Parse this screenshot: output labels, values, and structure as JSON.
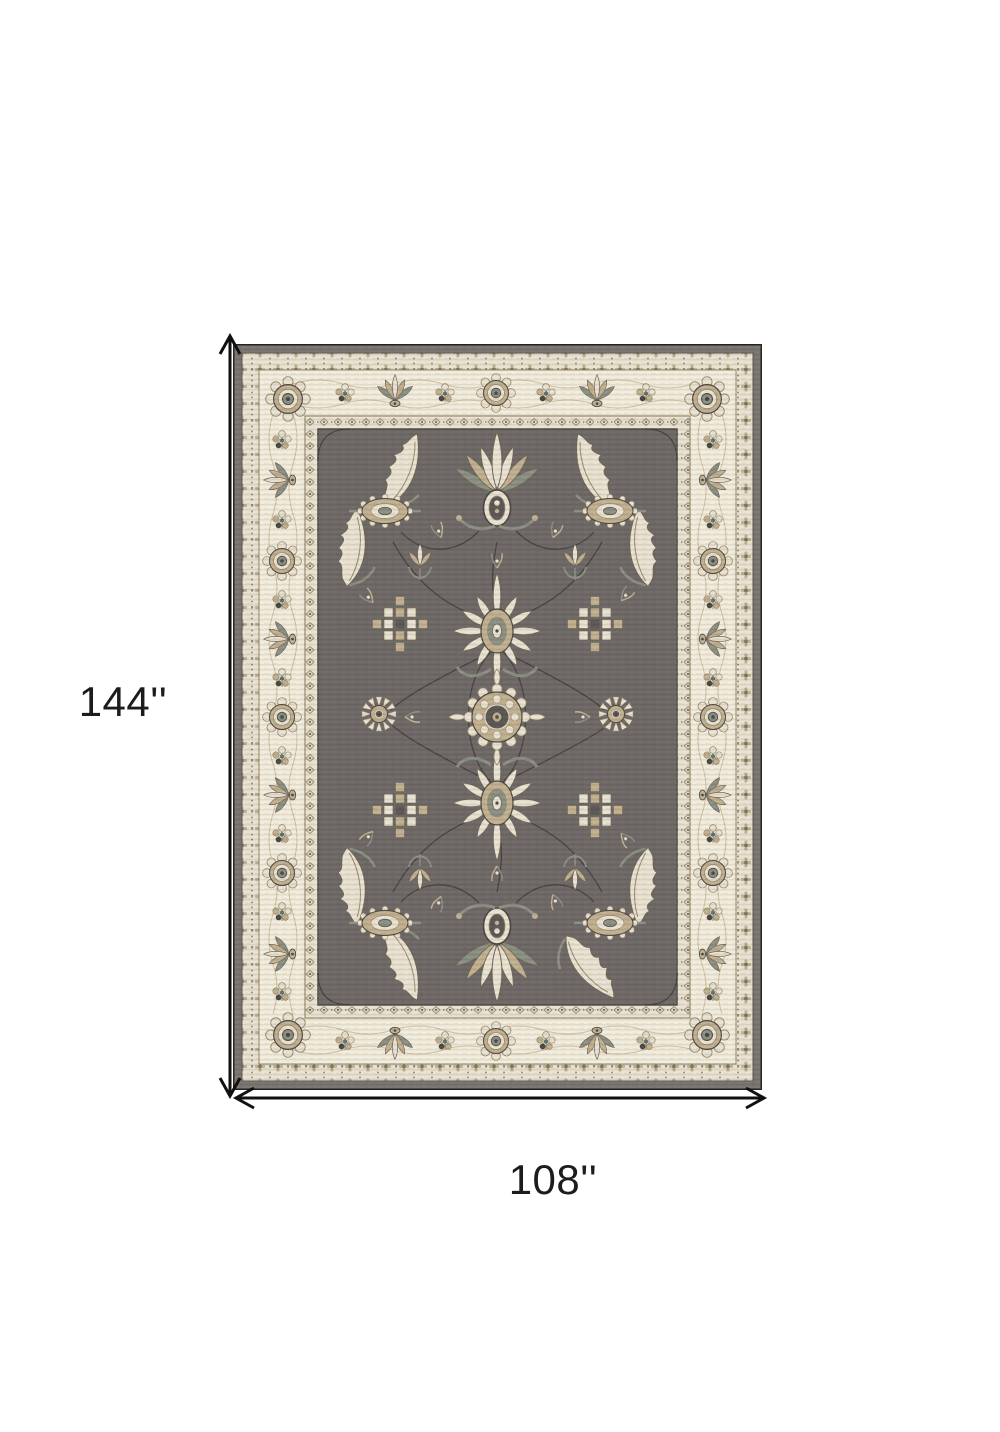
{
  "dimensions": {
    "height_label": "144''",
    "width_label": "108''"
  },
  "rug": {
    "name": "gray-and-ivory-oriental-area-rug",
    "style": "traditional floral bordered rug diagram",
    "colors": {
      "edge": "#7b7672",
      "edge_dark": "#4b4742",
      "field": "#6f6a67",
      "field_dark": "#5d5956",
      "ivory": "#e9e2d1",
      "ivory_hi": "#f2ecdc",
      "tan": "#c2b190",
      "tan_dark": "#998b6e",
      "olive": "#7d7a62",
      "sage": "#8c9184",
      "teal": "#5e7370",
      "dark": "#4c4843",
      "outline": "#6f6757",
      "vine": "#45423e",
      "arrow": "#111111",
      "label_text": "#1c1c1c",
      "page_bg": "#ffffff"
    }
  }
}
